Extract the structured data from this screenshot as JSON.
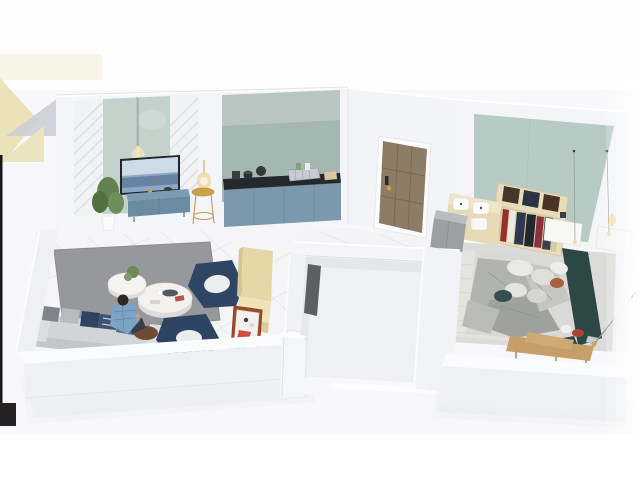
{
  "scene": {
    "title": "3D isometric cutaway floor plan render of a one-bedroom apartment",
    "style": "photorealistic dollhouse top-down view",
    "visible_text": "none"
  },
  "colors": {
    "background": "#fefefe",
    "ambient": "#f2f3f5",
    "wall_face": "#f4f5f8",
    "wall_side": "#eef0f4",
    "wall_top": "#fafbfd",
    "floor_marble": "#f5f5f7",
    "floor_carpet": "#dbdcda",
    "rug_gray": "#97989b",
    "rug_knit": "#e5e3dd",
    "sage_panel": "#c4d2cc",
    "kitchen_backsplash": "#a5b7b1",
    "bedroom_panel": "#b7cac4",
    "tv_cabinet_blue": "#6a8ba2",
    "kitchen_cabinet_blue": "#7b99ad",
    "counter_black": "#25282c",
    "sofa_gray": "#d2d4d8",
    "armchair_navy": "#2e4564",
    "bench_cream": "#e7d7a6",
    "table_terracotta": "#9e4b2d",
    "door_brown": "#8e7d66",
    "wardrobe_cream": "#e9dcba",
    "bed_frame_teal": "#2d4844",
    "bedding_gray": "#d9d9d7",
    "blanket_gray": "#b0b3af",
    "bench_wood": "#c59e68",
    "gold_accent": "#c9a24a",
    "plant_green": "#63814f",
    "person_shirt_blue": "#7da3c4",
    "logo_beige": "#ebe2ba",
    "logo_gray": "#c9cdd2",
    "mark_black": "#17181c"
  },
  "rooms": [
    {
      "id": "living-room",
      "label": "living room"
    },
    {
      "id": "dining-nook",
      "label": "dining nook"
    },
    {
      "id": "kitchen",
      "label": "kitchen"
    },
    {
      "id": "hallway",
      "label": "hallway with entry door"
    },
    {
      "id": "utility-room",
      "label": "empty white center room"
    },
    {
      "id": "bedroom",
      "label": "bedroom"
    }
  ],
  "furniture": {
    "living_room": [
      "tv wall with sage glass panel",
      "pendant light",
      "blue tv cabinet",
      "potted plant",
      "gold side table with lamp",
      "gray area rug",
      "round nesting coffee tables",
      "gray sofa with pillows",
      "two navy armchairs",
      "seated person in plaid shirt"
    ],
    "kitchen": [
      "teal backsplash",
      "black countertop",
      "blue base cabinets",
      "cookware",
      "dish rack",
      "cutting board"
    ],
    "dining_nook": [
      "cream booth bench",
      "terracotta table with white top",
      "red book"
    ],
    "hallway": [
      "wooden entry door with gold handle"
    ],
    "utility_room": [
      "dark wall panel",
      "white wall cabinet"
    ],
    "bedroom": [
      "teal accent wall",
      "open wardrobe with clothes and storage boxes",
      "gray storage cabinet",
      "double bed with dark teal frame",
      "gray bedding and pillows",
      "knit rug",
      "wooden foot bench",
      "two nightstands",
      "pendant light wires",
      "floor lamp wire"
    ]
  }
}
